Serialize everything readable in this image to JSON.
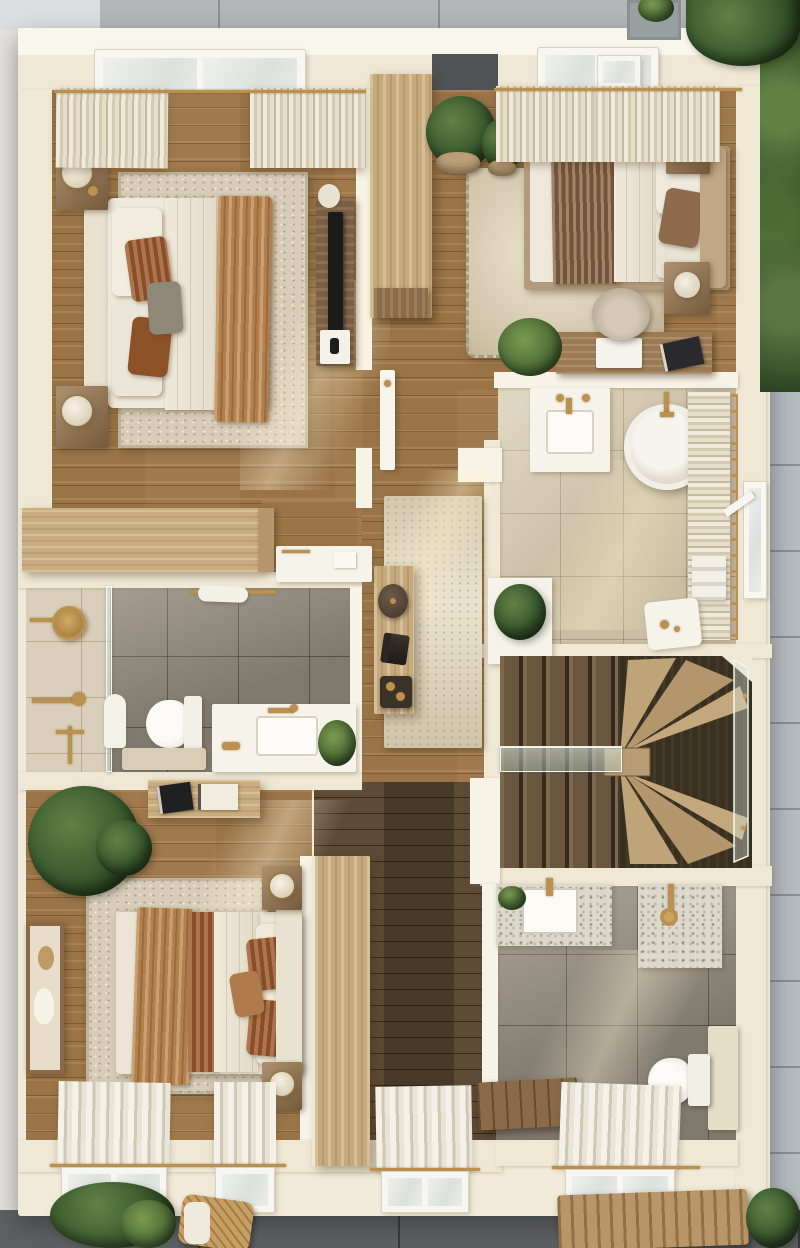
{
  "meta": {
    "title": "Top-down 3D rendered floor plan",
    "view": "top-down interior render",
    "style": "warm neutral, cream walls, oak floors, brass fixtures"
  },
  "palette": {
    "paving_top": "#afb3b4",
    "paving_right": "#b6bbc0",
    "paving_bottom": "#5e6163",
    "wall_cream": "#efe8d5",
    "wall_white": "#f7f3e6",
    "wood_mid": "#a07a4c",
    "wood_dark": "#54422f",
    "oak_light": "#c6a97c",
    "rug_cream": "#d7cdb8",
    "tile_beige": "#c9bda3",
    "tile_gray": "#8e877b",
    "textile_rust": "#9a5a30",
    "textile_caramel": "#b3804d",
    "textile_brown": "#8a6a4e",
    "gold": "#bb9152",
    "glass": "#d8e7df",
    "greenery": "#3a5a2e"
  },
  "rooms": [
    {
      "id": "bedroom-top-left",
      "label": "Primary bedroom",
      "furniture": [
        "double bed with cream headboard",
        "white duvet",
        "caramel knit throw",
        "rust and gray pillows",
        "two oak nightstands with lamps",
        "speckled area rug",
        "media console with TV",
        "sheer curtains",
        "skylight window"
      ]
    },
    {
      "id": "wardrobe-nook",
      "label": "Wardrobe nook",
      "furniture": [
        "tall oak wardrobe",
        "fiddle-leaf plants in pots",
        "open door"
      ]
    },
    {
      "id": "bedroom-top-right",
      "label": "Guest bedroom",
      "furniture": [
        "bed with tan platform frame",
        "brown pleated throw",
        "cream shag rug",
        "two nightstands with vases",
        "desk with laptop and book",
        "round desk chair",
        "potted palm",
        "sheer curtains",
        "skylight window"
      ]
    },
    {
      "id": "bathroom-right",
      "label": "Main bathroom",
      "furniture": [
        "round freestanding tub with brass floor faucet",
        "vanity with basin and brass taps",
        "window with sheer curtain",
        "brass towel ladder",
        "towel stack",
        "planter box",
        "stool"
      ]
    },
    {
      "id": "bathroom-left",
      "label": "Shower bathroom",
      "furniture": [
        "walk-in shower with glass screen",
        "brass rain shower head",
        "brass hand shower",
        "toilet with mat",
        "vanity with basin",
        "brass towel rail with towel",
        "plant"
      ]
    },
    {
      "id": "hallway",
      "label": "Hallway landing",
      "furniture": [
        "runner rug",
        "narrow console table",
        "dark vase",
        "black candle decor",
        "tray with cups"
      ]
    },
    {
      "id": "staircase",
      "label": "Staircase",
      "furniture": [
        "dark oak straight treads",
        "light oak winder treads",
        "glass balustrade with brass fittings"
      ]
    },
    {
      "id": "bedroom-bottom",
      "label": "Third bedroom",
      "furniture": [
        "bed with rust and caramel bedding",
        "area rug",
        "framed abstract art",
        "wall shelf with books",
        "two nightstands with lamps",
        "tall oak wardrobe",
        "large fiddle-leaf plant",
        "curtained windows"
      ]
    },
    {
      "id": "bathroom-bottom-right",
      "label": "Family bathroom",
      "furniture": [
        "terrazzo vanity with basin",
        "terrazzo shower panel with brass fixture",
        "wall-hung toilet",
        "half-height ledge wall",
        "wood slat bench",
        "curtained window"
      ]
    },
    {
      "id": "corridor-bottom",
      "label": "Rear corridor",
      "furniture": [
        "dark oak floor",
        "curtained window"
      ]
    }
  ],
  "exterior": {
    "top": "grey paving slabs",
    "top_right": "tree canopy and planter",
    "right": "green hedge then stone paving",
    "bottom": "dark paving with plants, rattan chair and woven bench",
    "left": "white side path"
  }
}
